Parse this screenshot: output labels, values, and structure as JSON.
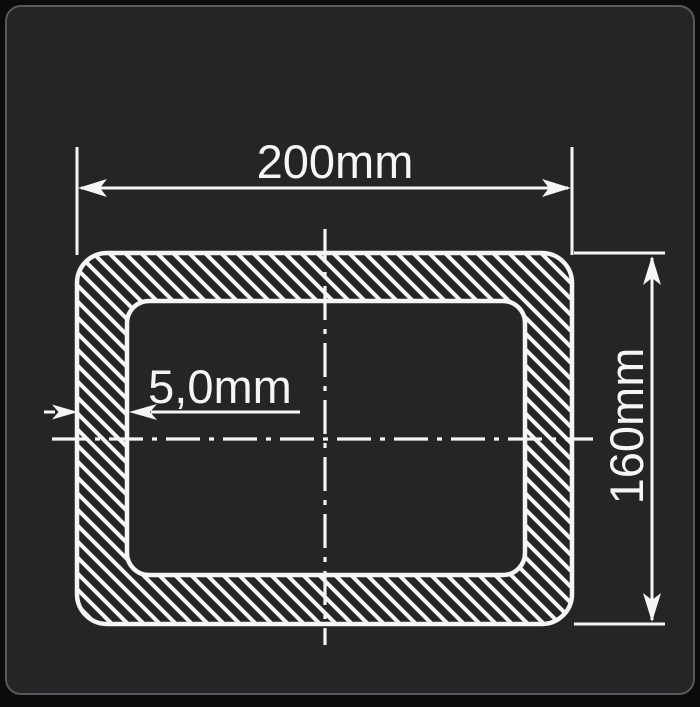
{
  "diagram": {
    "kind": "rectangular-hollow-section-cross-section",
    "labels": {
      "width": "200mm",
      "height": "160mm",
      "thickness": "5,0mm"
    },
    "values": {
      "width_mm": 200,
      "height_mm": 160,
      "thickness_mm": 5.0,
      "unit": "mm"
    }
  },
  "colors": {
    "page_bg": "#0b0b0b",
    "card_bg": "#252527",
    "card_border": "#58585c",
    "line": "#f5f5f5"
  }
}
